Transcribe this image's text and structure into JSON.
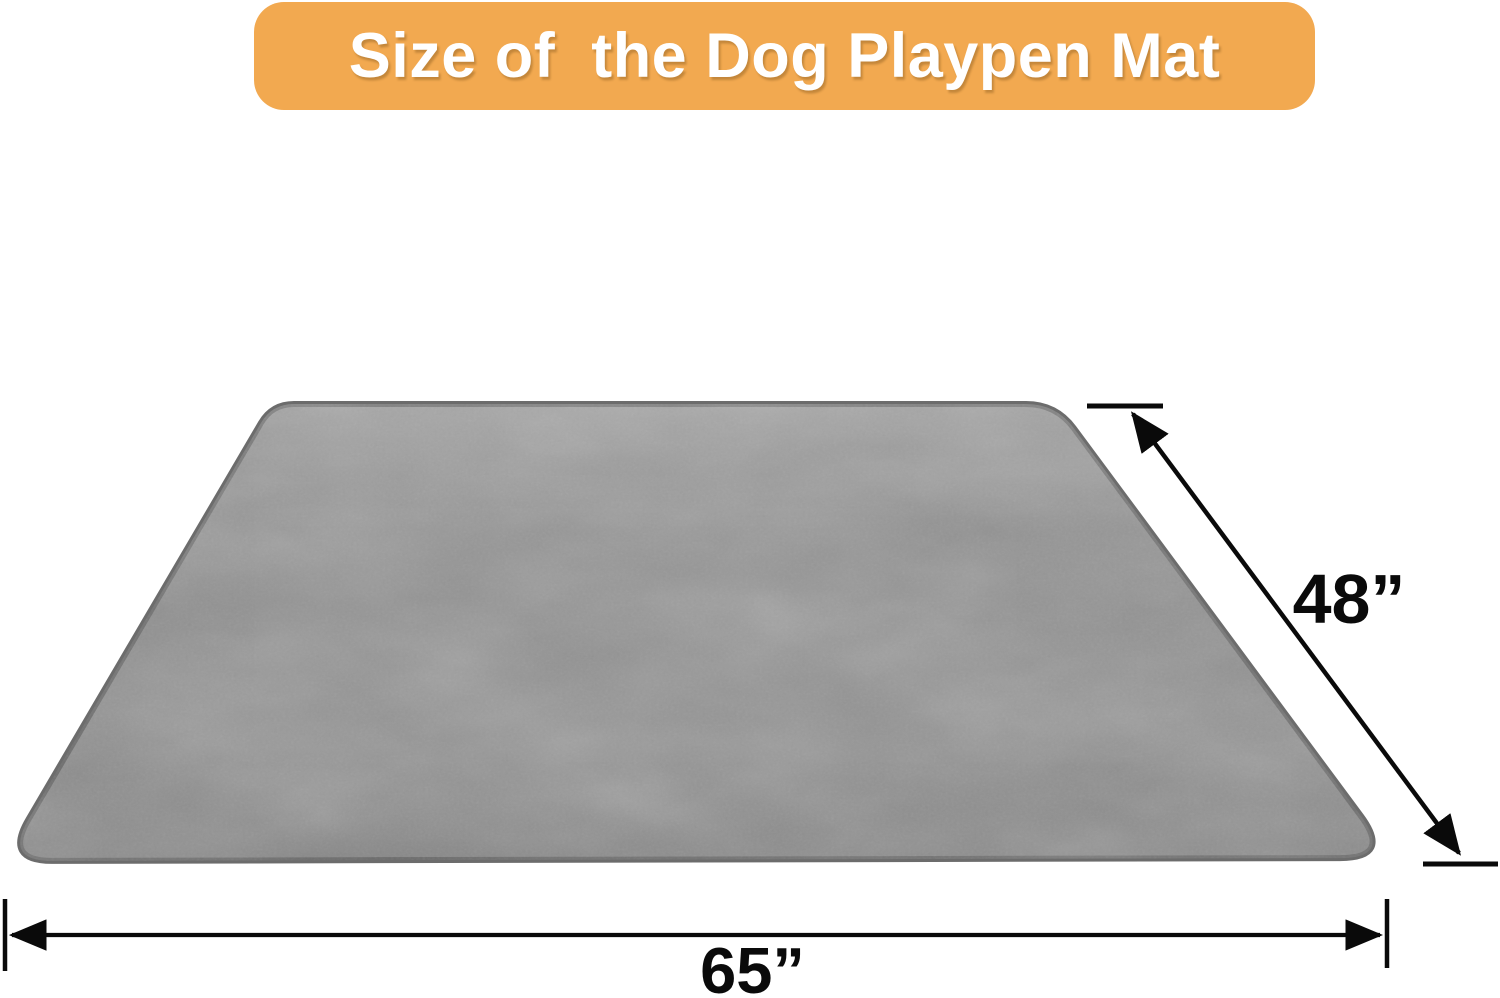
{
  "banner": {
    "title": "Size of  the Dog Playpen Mat"
  },
  "mat": {
    "name": "dog-playpen-mat"
  },
  "dimensions": {
    "depth": {
      "label": "48”"
    },
    "width": {
      "label": "65”"
    }
  },
  "colors": {
    "background": "#FFFFFF",
    "banner_bg": "#F2A950",
    "banner_text": "#FFFFFF",
    "mat_base": "#909090",
    "mat_edge": "#6C6C6C",
    "dimension_line": "#0A0A0A"
  }
}
